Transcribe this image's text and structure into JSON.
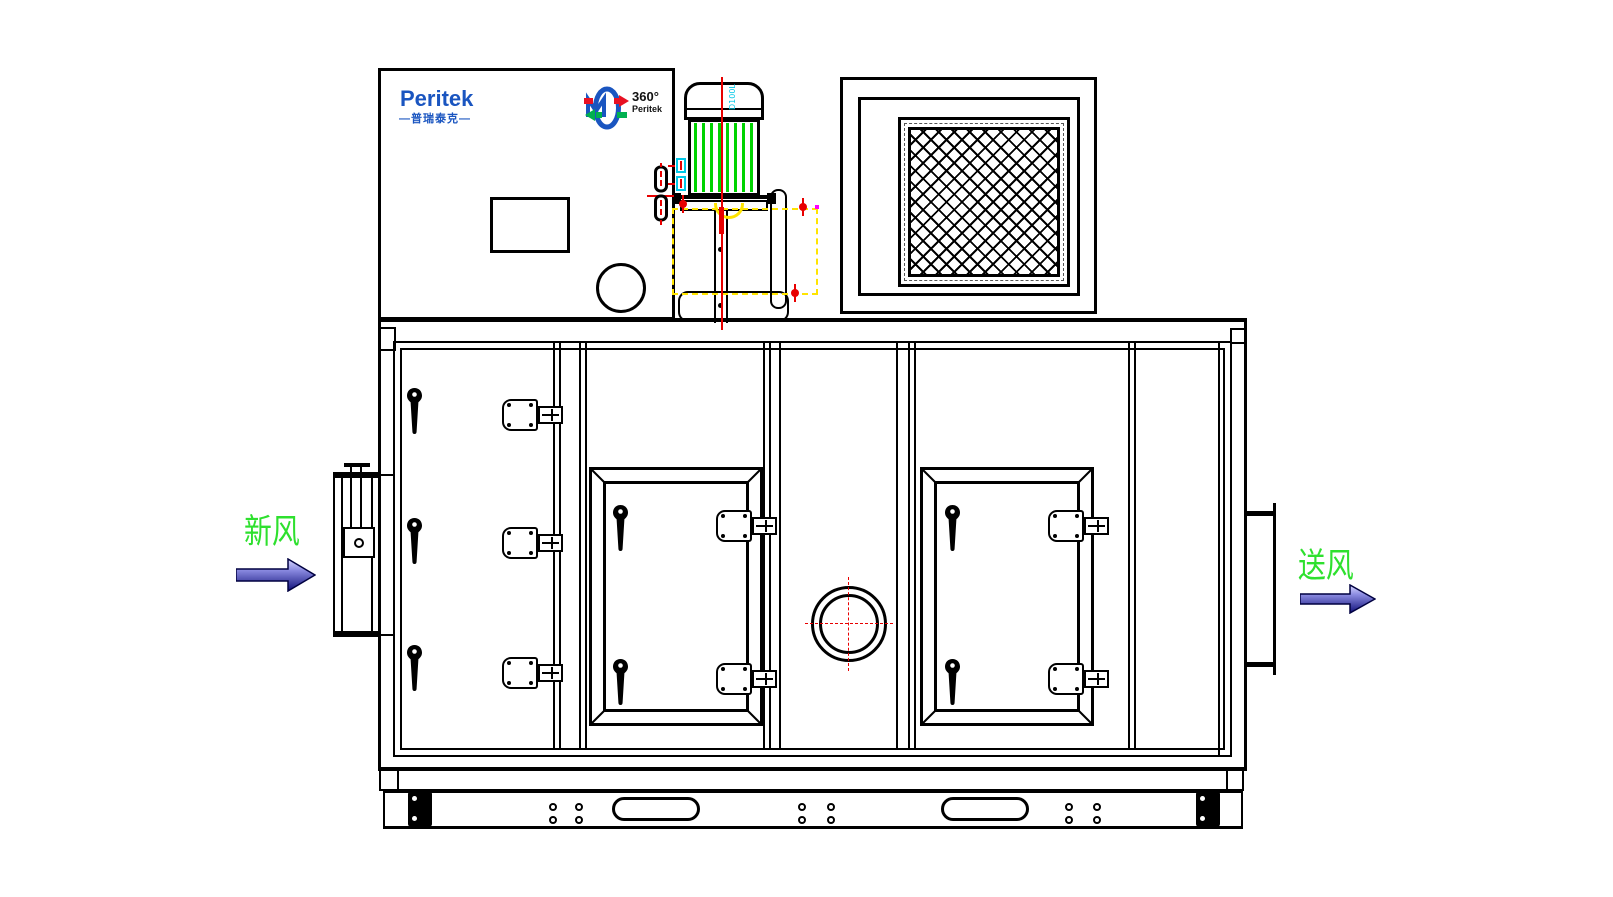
{
  "page": {
    "background": "#ffffff"
  },
  "brand": {
    "name": "Peritek",
    "tagline": "—普瑞泰克—",
    "color": "#1a55c0"
  },
  "wheel_badge": {
    "degrees": "360°",
    "brand": "Peritek"
  },
  "motor": {
    "frame_label": "D100L",
    "fin_color": "#00d400"
  },
  "flow": {
    "inlet_label": "新风",
    "outlet_label": "送风",
    "label_color": "#2ee02e"
  },
  "colors": {
    "line": "#000000",
    "centerline_red": "#e80000",
    "duct_dashed_yellow": "#ffe400",
    "terminal_cyan": "#00c8e8",
    "brand_blue": "#1a55c0",
    "arrow_gradient_top": "#d8d8ff",
    "arrow_gradient_bottom": "#10107a",
    "highlight_magenta": "#ff00ff"
  },
  "icons": {
    "rotary_wheel": "blue ellipse wheel with red and green flow arrows",
    "door_handle": "black teardrop handle",
    "door_latch": "cam latch with keeper tongue",
    "valve": "double-lozenge valve symbol with red centerline",
    "flow_arrow": "3D blue gradient arrow"
  }
}
